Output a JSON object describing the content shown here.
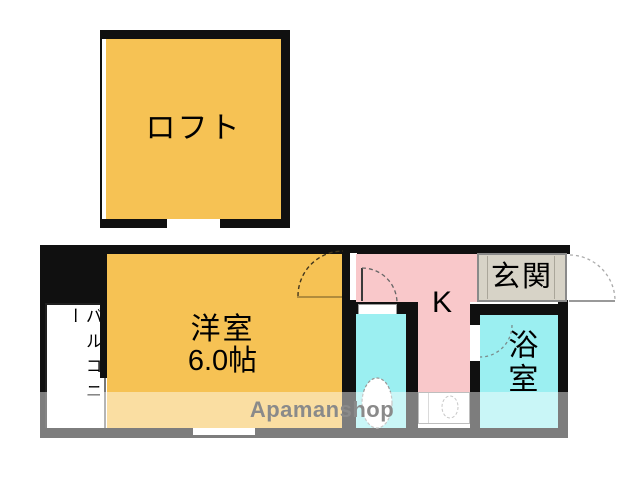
{
  "watermark": {
    "text": "Apamanshop"
  },
  "rooms": {
    "loft": {
      "label": "ロフト"
    },
    "western_room": {
      "label": "洋室",
      "size": "6.0帖"
    },
    "kitchen": {
      "label": "K"
    },
    "entrance": {
      "label": "玄関"
    },
    "bathroom": {
      "label": "浴室"
    },
    "toilet": {
      "label": ""
    },
    "balcony": {
      "label": "バルコニー"
    }
  },
  "colors": {
    "room_fill": "#F6C254",
    "kitchen_fill": "#F9C8CA",
    "wet_area_fill": "#9BEFF1",
    "entrance_fill": "#D7D3C7",
    "wall": "#101010",
    "watermark_gray": "#8A8A8A"
  }
}
